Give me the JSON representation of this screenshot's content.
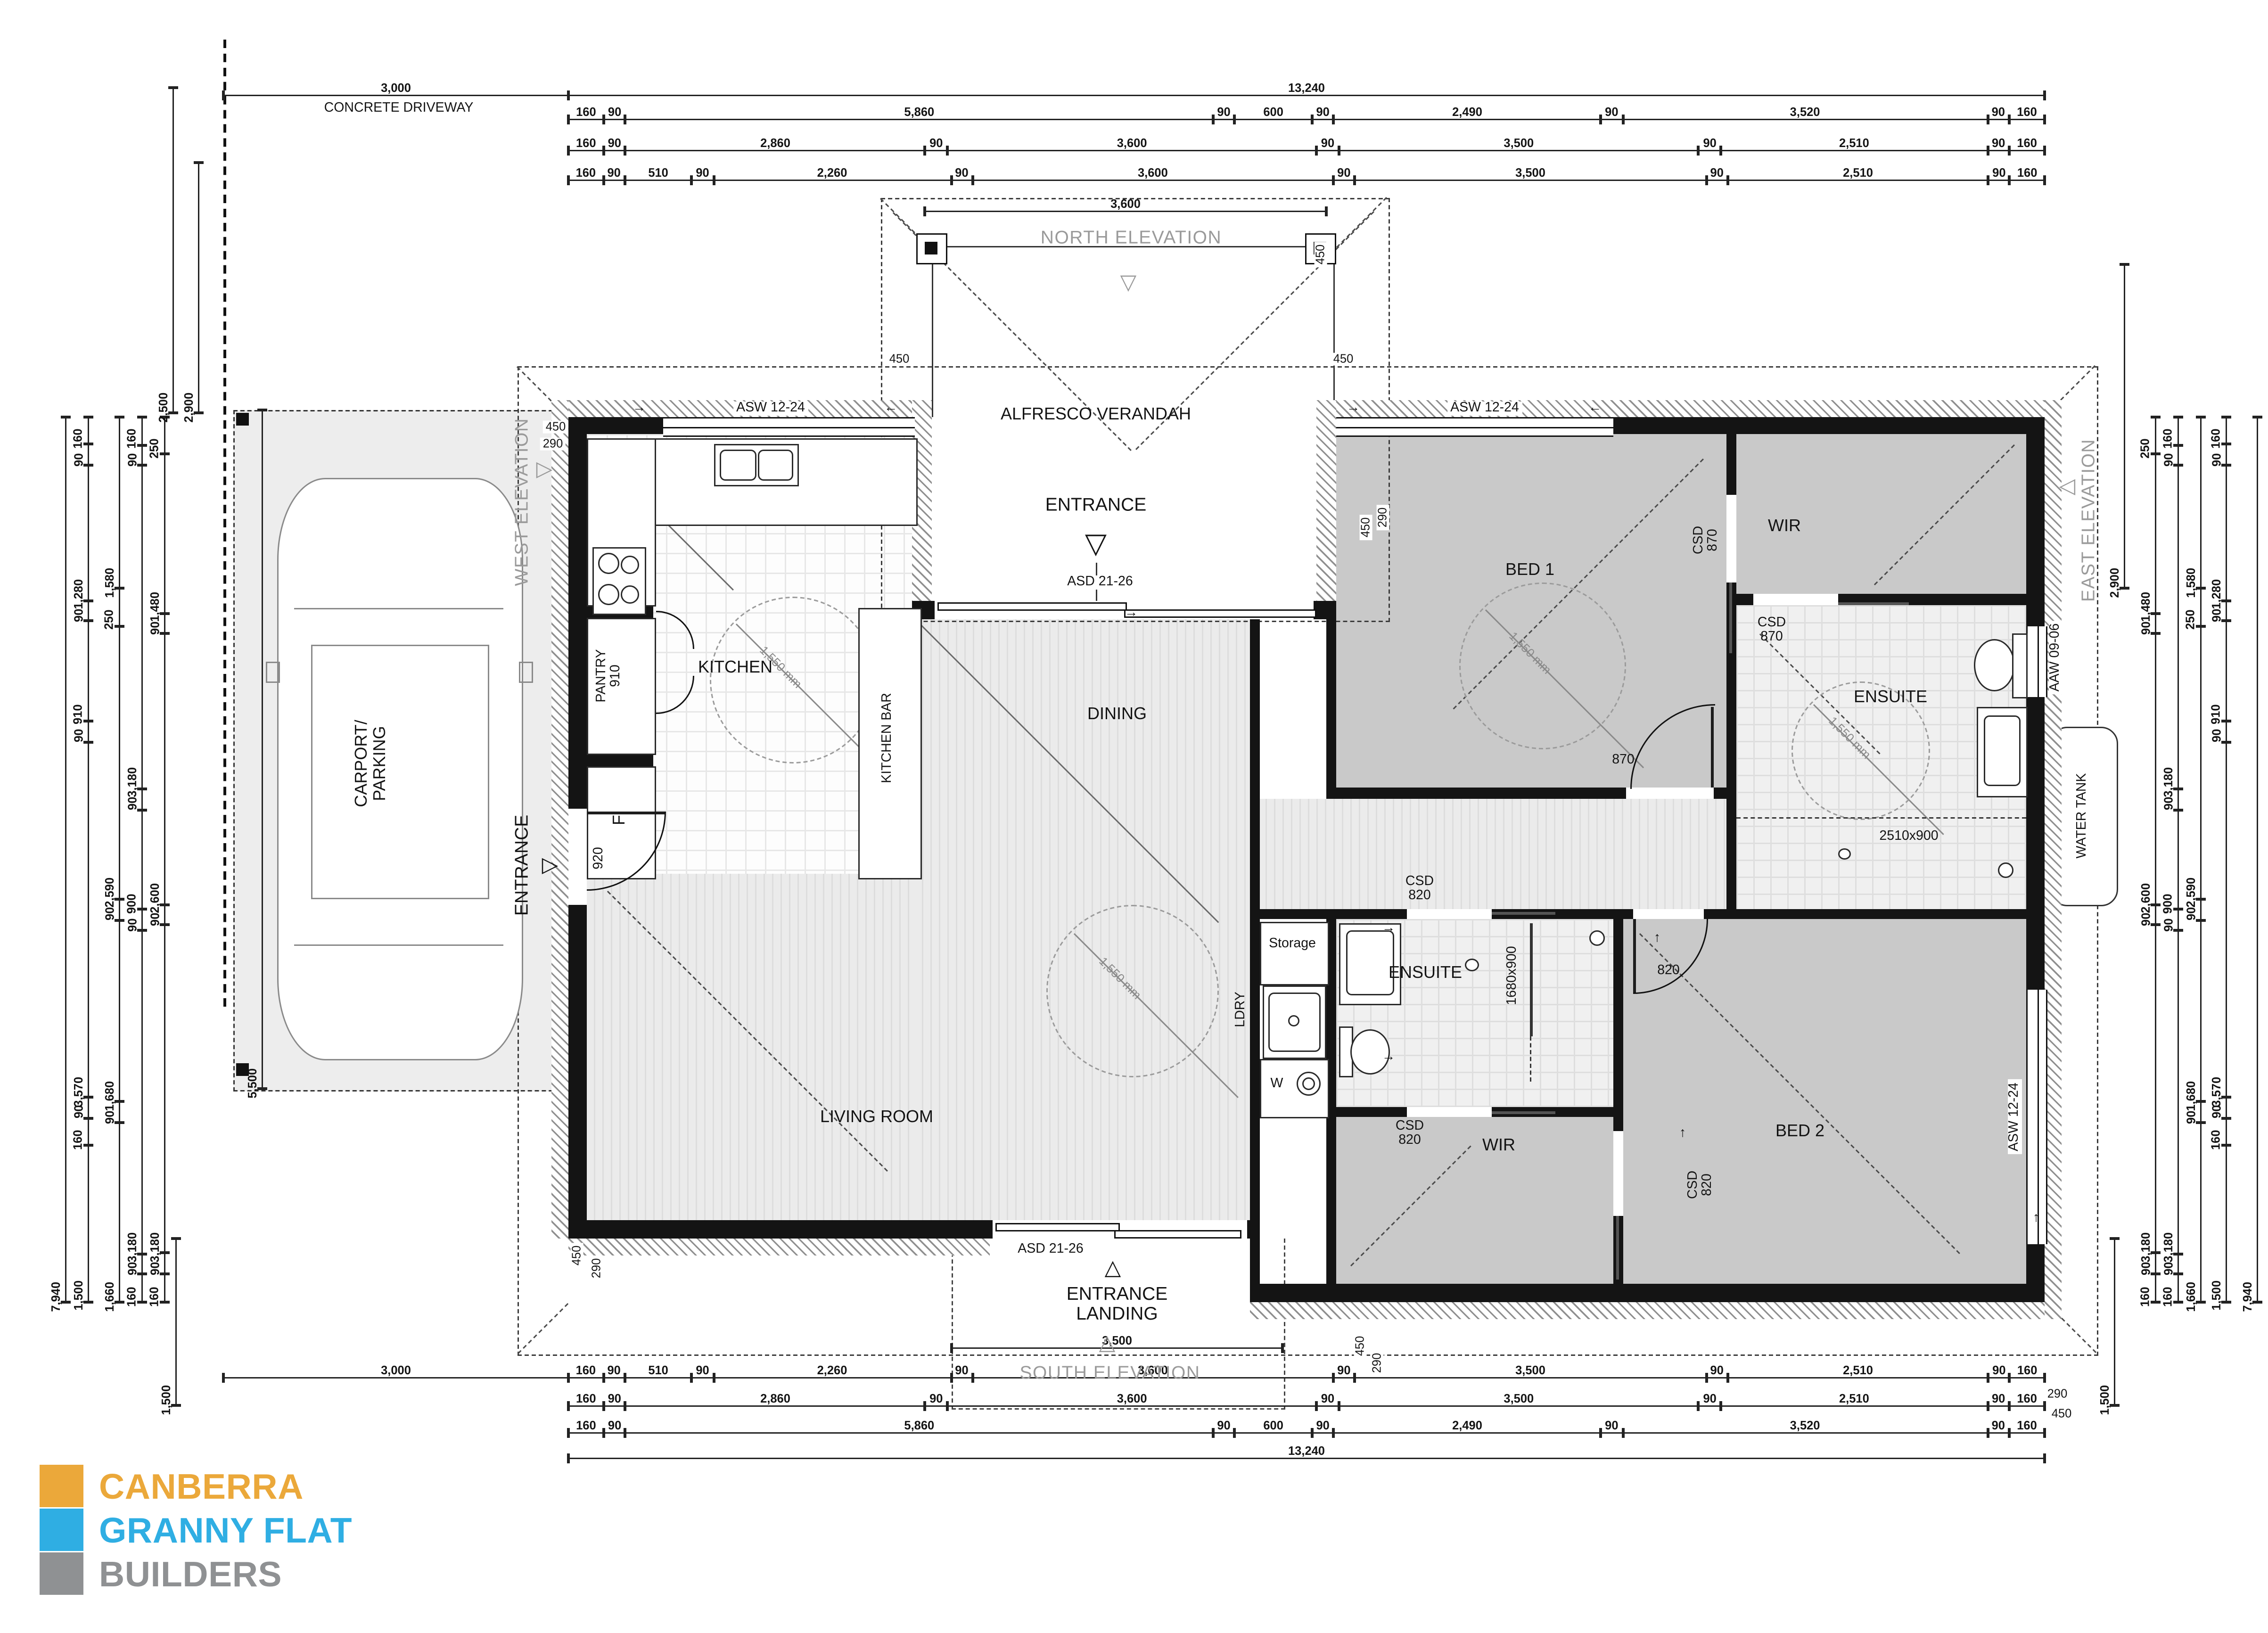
{
  "logo": {
    "line1": "CANBERRA",
    "line2": "GRANNY FLAT",
    "line3": "BUILDERS"
  },
  "colors": {
    "logo_orange": "#EBA83A",
    "logo_blue": "#2FAEE3",
    "logo_gray": "#8F9193",
    "room_gray": "#c9c9c9",
    "wall": "#141414",
    "elevation_text": "#9a9a9a"
  },
  "elevations": {
    "north": "NORTH ELEVATION",
    "south": "SOUTH ELEVATION",
    "east": "EAST ELEVATION",
    "west": "WEST ELEVATION"
  },
  "site": {
    "driveway": "CONCRETE DRIVEWAY",
    "carport_line1": "CARPORT/",
    "carport_line2": "PARKING",
    "water_tank": "WATER TANK",
    "entrance": "ENTRANCE",
    "landing_line1": "ENTRANCE",
    "landing_line2": "LANDING",
    "verandah": "ALFRESCO VERANDAH"
  },
  "rooms": {
    "kitchen": "KITCHEN",
    "kitchen_bar": "KITCHEN BAR",
    "pantry": "PANTRY",
    "pantry_width": "910",
    "fridge": "F",
    "dining": "DINING",
    "living": "LIVING ROOM",
    "bed1": "BED 1",
    "bed2": "BED 2",
    "wir": "WIR",
    "ensuite": "ENSUITE",
    "laundry": "LDRY",
    "storage": "Storage",
    "washer": "W"
  },
  "openings": {
    "asw": "ASW 12-24",
    "asd": "ASD 21-26",
    "aaw": "AAW 09-06",
    "csd": "CSD",
    "w870": "870",
    "w820": "820",
    "w920": "920",
    "shower_main": "2510x900",
    "shower_ensuite2": "1680x900"
  },
  "annotations": {
    "turning_circle": "1,550 mm",
    "eave_450": "450",
    "eave_290": "290"
  },
  "dimensions": {
    "top": {
      "overall": [
        "13,240"
      ],
      "driveway": [
        "3,000"
      ],
      "row1": [
        "160",
        "90",
        "5,860",
        "90",
        "600",
        "90",
        "2,490",
        "90",
        "3,520",
        "90",
        "160"
      ],
      "row2": [
        "160",
        "90",
        "2,860",
        "90",
        "3,600",
        "90",
        "3,500",
        "90",
        "2,510",
        "90",
        "160"
      ],
      "row3": [
        "160",
        "90",
        "510",
        "90",
        "2,260",
        "90",
        "3,600",
        "90",
        "3,500",
        "90",
        "2,510",
        "90",
        "160"
      ],
      "verandah": [
        "3,600"
      ]
    },
    "bottom": {
      "landing": [
        "3,500"
      ],
      "row1": [
        "160",
        "90",
        "510",
        "90",
        "2,260",
        "90",
        "3,600",
        "90",
        "3,500",
        "90",
        "2,510",
        "90",
        "160"
      ],
      "row2": [
        "160",
        "90",
        "2,860",
        "90",
        "3,600",
        "90",
        "3,500",
        "90",
        "2,510",
        "90",
        "160"
      ],
      "row3": [
        "160",
        "90",
        "5,860",
        "90",
        "600",
        "90",
        "2,490",
        "90",
        "3,520",
        "90",
        "160"
      ],
      "overall": [
        "13,240"
      ],
      "driveway": [
        "3,000"
      ]
    },
    "left": {
      "overall": [
        "7,940"
      ],
      "col1": [
        "160",
        "90",
        "1,280",
        "90",
        "910",
        "90",
        "3,570",
        "90",
        "160",
        "1,500"
      ],
      "col2": [
        "1,580",
        "250",
        "2,590",
        "90",
        "1,680",
        "90",
        "1,660"
      ],
      "col3": [
        "160",
        "90",
        "3,180",
        "90",
        "900",
        "90",
        "3,180",
        "90",
        "160"
      ],
      "col4": [
        "250",
        "1,480",
        "90",
        "2,600",
        "90",
        "3,180",
        "90",
        "160"
      ],
      "carport": [
        "5,500"
      ],
      "drive1": [
        "2,500"
      ],
      "drive2": [
        "2,900"
      ],
      "landing": [
        "1,500"
      ]
    },
    "right": {
      "overall": [
        "7,940"
      ],
      "col1": [
        "160",
        "90",
        "1,280",
        "90",
        "910",
        "90",
        "3,570",
        "90",
        "160",
        "1,500"
      ],
      "col2": [
        "1,580",
        "250",
        "2,590",
        "90",
        "1,680",
        "90",
        "1,660"
      ],
      "col3": [
        "160",
        "90",
        "3,180",
        "90",
        "900",
        "90",
        "3,180",
        "90",
        "160"
      ],
      "col4": [
        "250",
        "1,480",
        "90",
        "2,600",
        "90",
        "3,180",
        "90",
        "160"
      ],
      "top": [
        "2,900"
      ],
      "landing": [
        "1,500"
      ]
    }
  }
}
